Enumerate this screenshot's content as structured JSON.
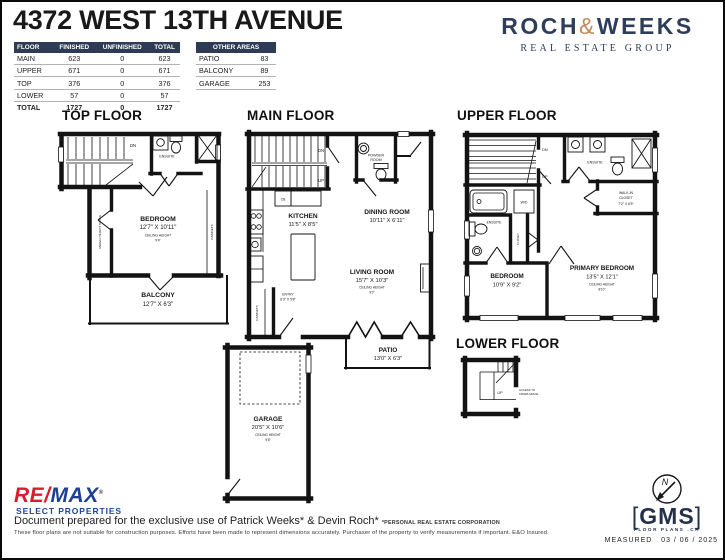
{
  "header": {
    "title": "4372 WEST 13TH AVENUE"
  },
  "floor_table": {
    "headers": [
      "FLOOR",
      "FINISHED",
      "UNFINISHED",
      "TOTAL"
    ],
    "rows": [
      [
        "MAIN",
        "623",
        "0",
        "623"
      ],
      [
        "UPPER",
        "671",
        "0",
        "671"
      ],
      [
        "TOP",
        "376",
        "0",
        "376"
      ],
      [
        "LOWER",
        "57",
        "0",
        "57"
      ],
      [
        "TOTAL",
        "1727",
        "0",
        "1727"
      ]
    ]
  },
  "other_table": {
    "title": "OTHER AREAS",
    "rows": [
      [
        "PATIO",
        "83"
      ],
      [
        "BALCONY",
        "89"
      ],
      [
        "GARAGE",
        "253"
      ]
    ]
  },
  "brand": {
    "name1": "ROCH",
    "amp": "&",
    "name2": "WEEKS",
    "tagline": "REAL ESTATE GROUP"
  },
  "colors": {
    "navy": "#2d3b55",
    "gold": "#c08a55",
    "remax_red": "#dc1c2e",
    "remax_blue": "#1d3f94",
    "gms_navy": "#25304a"
  },
  "floors": {
    "top": {
      "label": "TOP FLOOR",
      "dn": "DN",
      "ensuite": "ENSUITE",
      "bedroom": "BEDROOM",
      "bedroom_dim": "12'7\" X 10'11\"",
      "ceiling_label": "CEILING HEIGHT",
      "ceiling_value": "9'4\"",
      "under_height": "UNDER HEIGHT SPACE",
      "cabinets": "CABINETS",
      "balcony": "BALCONY",
      "balcony_dim": "12'7\" X 6'3\""
    },
    "main": {
      "label": "MAIN FLOOR",
      "dn": "DN",
      "up": "UP",
      "powder1": "POWDER",
      "powder2": "ROOM",
      "cb": "CB",
      "kitchen": "KITCHEN",
      "kitchen_dim": "11'5\" X 8'5\"",
      "dining": "DINING ROOM",
      "dining_dim": "10'11\" X 6'11\"",
      "living": "LIVING ROOM",
      "living_dim": "15'7\" X 10'3\"",
      "ceiling_label": "CEILING HEIGHT",
      "ceiling_value": "9'0\"",
      "entry": "ENTRY",
      "entry_dim": "6'3\" X 5'8\"",
      "cabinets": "CABINETS",
      "patio": "PATIO",
      "patio_dim": "13'0\" X 6'3\"",
      "garage": "GARAGE",
      "garage_dim": "20'5\" X 10'6\"",
      "garage_ceiling_label": "CEILING HEIGHT",
      "garage_ceiling_value": "9'8\""
    },
    "upper": {
      "label": "UPPER FLOOR",
      "dn": "DN",
      "up": "UP",
      "ensuite_top": "ENSUITE",
      "ensuite_left": "ENSUITE",
      "wic1": "WALK-IN",
      "wic2": "CLOSET",
      "wic_dim": "7'2\" X 6'5\"",
      "wd": "W/D",
      "closet": "CLOSET",
      "bedroom": "BEDROOM",
      "bedroom_dim": "10'9\" X 9'2\"",
      "primary": "PRIMARY BEDROOM",
      "primary_dim": "13'5\" X 12'1\"",
      "ceiling_label": "CEILING HEIGHT",
      "ceiling_value": "8'10\""
    },
    "lower": {
      "label": "LOWER FLOOR",
      "up": "UP",
      "access1": "ACCESS TO",
      "access2": "CRAWLSPACE"
    }
  },
  "footer": {
    "remax_re": "RE",
    "remax_slash": "/",
    "remax_max": "MAX",
    "remax_reg": "®",
    "remax_sub": "SELECT PROPERTIES",
    "prepared": "Document prepared for the exclusive use of Patrick Weeks* & Devin Roch*",
    "prepared_note": "*PERSONAL REAL ESTATE CORPORATION",
    "disclaimer": "These floor plans are not suitable for construction purposes. Efforts have been made to represent dimensions accurately.  Purchaser of the property to verify measurements if important.  E&O Insured.",
    "gms_open": "[",
    "gms": "GMS",
    "gms_close": "]",
    "gms_sub": "FLOOR PLANS .CA",
    "compass_n": "N",
    "measured_label": "MEASURED",
    "measured_value": "03 / 06 / 2025"
  }
}
